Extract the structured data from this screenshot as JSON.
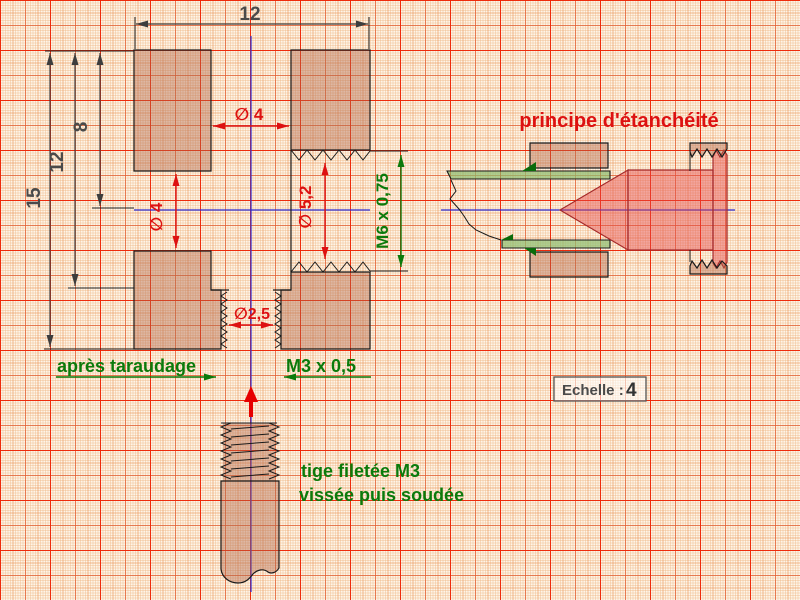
{
  "colors": {
    "paper": "#fdf5e9",
    "grid_major": "#f01e00",
    "grid_mid": "#e15a32",
    "grid_minor": "#eb965a",
    "grid_fine": "#f0b987",
    "outline_black": "#1a1a1a",
    "axis_blue": "#2b2bd0",
    "dim_gray": "#4a4a4a",
    "dim_red": "#dd1111",
    "label_green": "#0b7a0b",
    "material_tan": "rgba(176,100,72,0.42)",
    "screw_pink": "rgba(229,72,72,0.45)",
    "screw_outline": "#a52a2a",
    "seal_light_green": "rgba(140,190,110,0.7)",
    "seal_dark_green": "#0b6b0b"
  },
  "section_view": {
    "dim_overall_width": "12",
    "dim_overall_height": "15",
    "dim_bore_depth": "12",
    "dim_axis_height": "8",
    "dia_top_bore": "∅ 4",
    "dia_side_hole": "∅ 4",
    "dia_tapping_hole": "∅ 5,2",
    "dia_bottom_hole": "∅2,5",
    "thread_side_label": "M6 x 0,75",
    "thread_bottom_label": "M3 x 0,5",
    "tapping_note": "après taraudage"
  },
  "seal_view": {
    "title": "principe d'étanchéité"
  },
  "rod_note": {
    "line1": "tige filetée M3",
    "line2": "vissée puis soudée"
  },
  "scale_box": {
    "label": "Echelle :",
    "value": "4"
  }
}
